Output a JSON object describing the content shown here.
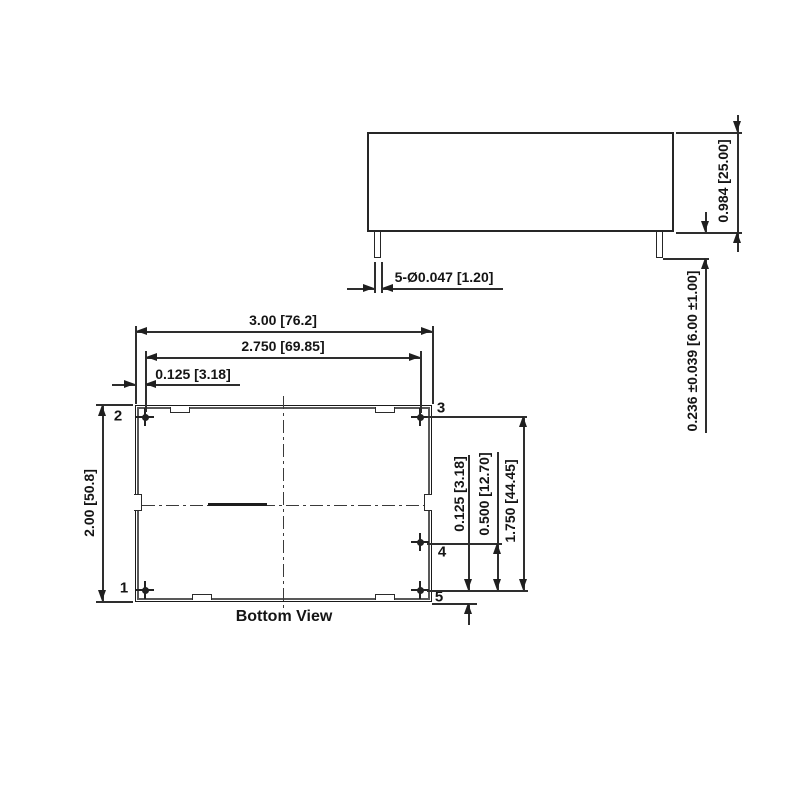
{
  "colors": {
    "line": "#2e2e2e",
    "background": "#ffffff",
    "text": "#151515"
  },
  "side_view": {
    "body_height_dim": "0.984 [25.00]",
    "pin_length_dim": "0.236 ±0.039 [6.00 ±1.00]",
    "pin_diameter_dim": "5-Ø0.047 [1.20]"
  },
  "bottom_view": {
    "title": "Bottom View",
    "overall_width_dim": "3.00 [76.2]",
    "pin_row_span_dim": "2.750 [69.85]",
    "pin_edge_offset_dim": "0.125 [3.18]",
    "overall_height_dim": "2.00 [50.8]",
    "pin5_edge_offset_dim": "0.125 [3.18]",
    "pin4_to_pin5_dim": "0.500 [12.70]",
    "pin3_to_pin5_dim": "1.750 [44.45]",
    "pin_labels": {
      "p1": "1",
      "p2": "2",
      "p3": "3",
      "p4": "4",
      "p5": "5"
    }
  }
}
